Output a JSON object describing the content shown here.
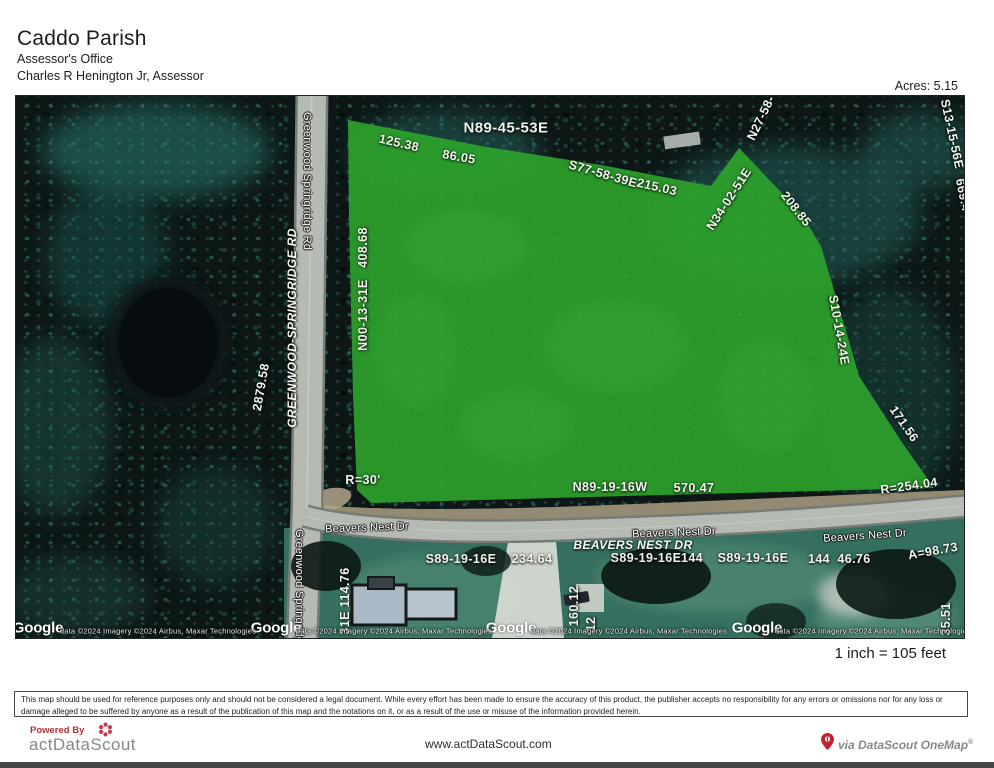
{
  "header": {
    "title": "Caddo Parish",
    "office": "Assessor's Office",
    "assessor": "Charles R Henington Jr, Assessor",
    "acres": "Acres: 5.15"
  },
  "scale_note": "1 inch = 105 feet",
  "disclaimer": "This map should be used for reference purposes only and should not be considered a legal document.  While every effort has been made to ensure the accuracy of this product, the publisher accepts no responsibility for any errors or omissions nor for any loss or damage alleged to be suffered by anyone as a result of the publication of this map and the notations on it, or as a result of the use or misuse of the information provided herein.",
  "footer": {
    "powered_by": "Powered By",
    "brand": "actDataScout",
    "website": "www.actDataScout.com",
    "onemap": "via DataScout OneMap",
    "registered": "®"
  },
  "map": {
    "colors": {
      "parcel_green": "#2da42c",
      "forest_dark": "#0d1716",
      "road_gray": "#b5bab3",
      "shoulder_tan": "#a3967b",
      "grass": "#356f60"
    },
    "labels": [
      {
        "text": "125.38",
        "x": 383,
        "y": 47,
        "rot": 13,
        "cls": "survey",
        "name": "survey-label"
      },
      {
        "text": "N89-45-53E",
        "x": 490,
        "y": 32,
        "rot": 0,
        "cls": "survey lg",
        "name": "survey-label"
      },
      {
        "text": "86.05",
        "x": 443,
        "y": 61,
        "rot": 10,
        "cls": "survey",
        "name": "survey-label"
      },
      {
        "text": "S77-58-39E",
        "x": 587,
        "y": 78,
        "rot": 16,
        "cls": "survey",
        "name": "survey-label"
      },
      {
        "text": "215.03",
        "x": 641,
        "y": 91,
        "rot": 13,
        "cls": "survey",
        "name": "survey-label"
      },
      {
        "text": "N27-58-",
        "x": 745,
        "y": 22,
        "rot": -64,
        "cls": "survey",
        "name": "survey-label"
      },
      {
        "text": "N34-02-51E",
        "x": 713,
        "y": 103,
        "rot": -57,
        "cls": "survey",
        "name": "survey-label"
      },
      {
        "text": "208.85",
        "x": 780,
        "y": 113,
        "rot": 52,
        "cls": "survey",
        "name": "survey-label"
      },
      {
        "text": "S13-15-56E",
        "x": 936,
        "y": 38,
        "rot": 78,
        "cls": "survey",
        "name": "survey-label"
      },
      {
        "text": "669.4",
        "x": 947,
        "y": 99,
        "rot": 78,
        "cls": "survey",
        "name": "survey-label"
      },
      {
        "text": "S10-14-24E",
        "x": 823,
        "y": 234,
        "rot": 80,
        "cls": "survey",
        "name": "survey-label"
      },
      {
        "text": "171.56",
        "x": 888,
        "y": 328,
        "rot": 55,
        "cls": "survey",
        "name": "survey-label"
      },
      {
        "text": "R=254.04",
        "x": 893,
        "y": 390,
        "rot": -8,
        "cls": "survey",
        "name": "survey-label"
      },
      {
        "text": "N89-19-16W",
        "x": 594,
        "y": 391,
        "rot": 0,
        "cls": "survey",
        "name": "survey-label"
      },
      {
        "text": "570.47",
        "x": 678,
        "y": 392,
        "rot": 0,
        "cls": "survey",
        "name": "survey-label"
      },
      {
        "text": "R=30'",
        "x": 347,
        "y": 384,
        "rot": 0,
        "cls": "survey",
        "name": "survey-label"
      },
      {
        "text": "N00-13-31E   408.68",
        "x": 347,
        "y": 193,
        "rot": -90,
        "cls": "survey",
        "name": "survey-label"
      },
      {
        "text": "2879.58",
        "x": 245,
        "y": 291,
        "rot": -80,
        "cls": "survey",
        "name": "survey-label"
      },
      {
        "text": "S89-19-16E",
        "x": 445,
        "y": 463,
        "rot": 0,
        "cls": "survey",
        "name": "survey-label"
      },
      {
        "text": "234.64",
        "x": 516,
        "y": 463,
        "rot": 0,
        "cls": "survey",
        "name": "survey-label"
      },
      {
        "text": "S89-19-16E",
        "x": 630,
        "y": 462,
        "rot": 0,
        "cls": "survey",
        "name": "survey-label"
      },
      {
        "text": "144",
        "x": 676,
        "y": 462,
        "rot": 0,
        "cls": "survey",
        "name": "survey-label"
      },
      {
        "text": "S89-19-16E",
        "x": 737,
        "y": 462,
        "rot": 0,
        "cls": "survey",
        "name": "survey-label"
      },
      {
        "text": "144",
        "x": 803,
        "y": 463,
        "rot": 0,
        "cls": "survey",
        "name": "survey-label"
      },
      {
        "text": "46.76",
        "x": 838,
        "y": 463,
        "rot": 0,
        "cls": "survey",
        "name": "survey-label"
      },
      {
        "text": "A=98.73",
        "x": 917,
        "y": 455,
        "rot": -10,
        "cls": "survey",
        "name": "survey-label"
      },
      {
        "text": "31E 114.76",
        "x": 329,
        "y": 505,
        "rot": -90,
        "cls": "survey",
        "name": "survey-label"
      },
      {
        "text": "160.12",
        "x": 558,
        "y": 510,
        "rot": -90,
        "cls": "survey",
        "name": "survey-label"
      },
      {
        "text": "12",
        "x": 575,
        "y": 528,
        "rot": -90,
        "cls": "survey",
        "name": "survey-label"
      },
      {
        "text": "35.51",
        "x": 930,
        "y": 523,
        "rot": -90,
        "cls": "survey",
        "name": "survey-label"
      },
      {
        "text": "GREENWOOD-SPRINGRIDGE RD",
        "x": 276,
        "y": 232,
        "rot": -90,
        "cls": "roadname",
        "name": "road-name-label"
      },
      {
        "text": "BEAVERS NEST DR",
        "x": 617,
        "y": 449,
        "rot": 0,
        "cls": "roadname",
        "name": "road-name-label"
      },
      {
        "text": "Greenwood Springridge Rd",
        "x": 291,
        "y": 85,
        "rot": 90,
        "cls": "gmap",
        "name": "street-label"
      },
      {
        "text": "Greenwood Springridge Rd",
        "x": 283,
        "y": 502,
        "rot": 90,
        "cls": "gmap",
        "name": "street-label"
      },
      {
        "text": "Beavers Nest Dr",
        "x": 351,
        "y": 432,
        "rot": -2,
        "cls": "gmap",
        "name": "street-label"
      },
      {
        "text": "Beavers Nest Dr",
        "x": 658,
        "y": 437,
        "rot": -2,
        "cls": "gmap",
        "name": "street-label"
      },
      {
        "text": "Beavers Nest Dr",
        "x": 849,
        "y": 440,
        "rot": -4,
        "cls": "gmap",
        "name": "street-label"
      },
      {
        "text": "Google",
        "x": 22,
        "y": 532,
        "rot": 0,
        "cls": "watermark",
        "name": "google-watermark"
      },
      {
        "text": "Google",
        "x": 260,
        "y": 532,
        "rot": 0,
        "cls": "watermark",
        "name": "google-watermark"
      },
      {
        "text": "Google",
        "x": 495,
        "y": 532,
        "rot": 0,
        "cls": "watermark",
        "name": "google-watermark"
      },
      {
        "text": "Google",
        "x": 741,
        "y": 532,
        "rot": 0,
        "cls": "watermark",
        "name": "google-watermark"
      },
      {
        "text": "data ©2024 Imagery ©2024 Airbus, Maxar Technologies",
        "x": 142,
        "y": 535,
        "rot": 0,
        "cls": "attrib",
        "name": "map-attribution"
      },
      {
        "text": "data ©2024 Imagery ©2024 Airbus, Maxar Technologies",
        "x": 378,
        "y": 535,
        "rot": 0,
        "cls": "attrib",
        "name": "map-attribution"
      },
      {
        "text": "data ©2024 Imagery ©2024 Airbus, Maxar Technologies",
        "x": 613,
        "y": 535,
        "rot": 0,
        "cls": "attrib",
        "name": "map-attribution"
      },
      {
        "text": "data ©2024 Imagery ©2024 Airbus, Maxar Technologies",
        "x": 857,
        "y": 535,
        "rot": 0,
        "cls": "attrib",
        "name": "map-attribution"
      }
    ]
  }
}
